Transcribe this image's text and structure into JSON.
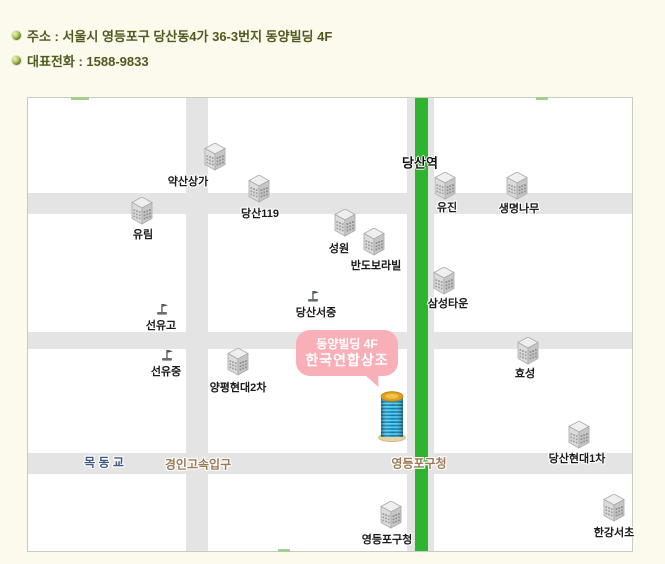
{
  "header": {
    "address": "주소 : 서울시 영등포구 당산동4가 36-3번지 동양빌딩 4F",
    "phone": "대표전화 : 1588-9833"
  },
  "map": {
    "station_label": "당산역",
    "callout": {
      "line1": "동양빌딩 4F",
      "line2": "한국연합상조",
      "color": "#f8afb7"
    },
    "target_building": "동양빌딩",
    "colors": {
      "page_bg": "#fbfaec",
      "map_bg": "#ffffff",
      "road": "#e4e4e4",
      "green_road": "#2fb42f",
      "header_text": "#4f5a1f",
      "bridge_label": "#3d5a85",
      "road_name_label": "#9b7b57"
    },
    "buildings": [
      {
        "label": "약산상가",
        "icon_x": 187,
        "icon_y": 59,
        "label_x": 160,
        "label_y": 83
      },
      {
        "label": "당산119",
        "icon_x": 231,
        "icon_y": 91,
        "label_x": 232,
        "label_y": 115
      },
      {
        "label": "유림",
        "icon_x": 114,
        "icon_y": 113,
        "label_x": 115,
        "label_y": 136
      },
      {
        "label": "성원",
        "icon_x": 317,
        "icon_y": 125,
        "label_x": 311,
        "label_y": 150
      },
      {
        "label": "반도보라빌",
        "icon_x": 346,
        "icon_y": 144,
        "label_x": 348,
        "label_y": 167
      },
      {
        "label": "유진",
        "icon_x": 417,
        "icon_y": 88,
        "label_x": 419,
        "label_y": 109
      },
      {
        "label": "생명나무",
        "icon_x": 489,
        "icon_y": 88,
        "label_x": 491,
        "label_y": 110
      },
      {
        "label": "삼성타운",
        "icon_x": 416,
        "icon_y": 183,
        "label_x": 420,
        "label_y": 205
      },
      {
        "label": "양평현대2차",
        "icon_x": 210,
        "icon_y": 264,
        "label_x": 210,
        "label_y": 289
      },
      {
        "label": "효성",
        "icon_x": 500,
        "icon_y": 253,
        "label_x": 497,
        "label_y": 275
      },
      {
        "label": "당산현대1차",
        "icon_x": 551,
        "icon_y": 337,
        "label_x": 549,
        "label_y": 360
      },
      {
        "label": "한강서초",
        "icon_x": 586,
        "icon_y": 410,
        "label_x": 586,
        "label_y": 434
      },
      {
        "label": "영등포구청",
        "icon_x": 363,
        "icon_y": 417,
        "label_x": 359,
        "label_y": 441
      }
    ],
    "schools": [
      {
        "label": "선유고",
        "icon_x": 134,
        "icon_y": 211,
        "label_x": 133,
        "label_y": 227
      },
      {
        "label": "당산서중",
        "icon_x": 285,
        "icon_y": 198,
        "label_x": 288,
        "label_y": 214
      },
      {
        "label": "선유중",
        "icon_x": 139,
        "icon_y": 257,
        "label_x": 138,
        "label_y": 273
      }
    ],
    "road_labels": [
      {
        "text": "목 동 교",
        "x": 76,
        "y": 364,
        "color": "#3d5a85"
      },
      {
        "text": "경인고속입구",
        "x": 170,
        "y": 366,
        "color": "#9b7b57"
      },
      {
        "text": "영등포구청",
        "x": 391,
        "y": 365,
        "color": "#9b7b57"
      }
    ]
  }
}
